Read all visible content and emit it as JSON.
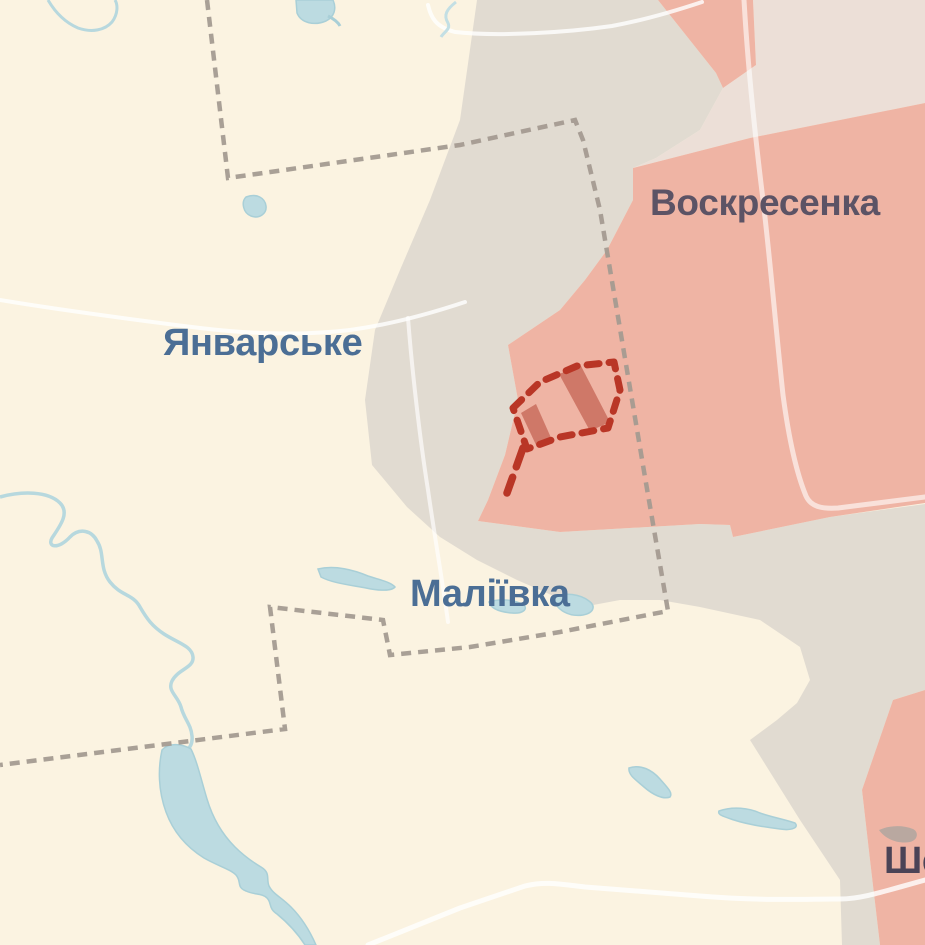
{
  "map": {
    "kind": "frontline-war-map",
    "labels": {
      "voskresenka": "Воскресенка",
      "yanvarske": "Январське",
      "maliivka": "Маліївка",
      "she_partial": "Ше"
    },
    "colors": {
      "background": "#fbf3e1",
      "grey_zone": "#e1dbd1",
      "pale_zone": "#ecdfd7",
      "occupied_pink": "#efb4a4",
      "advance_red": "#b93626",
      "advance_hatch": "rgba(175,60,44,0.5)",
      "admin_boundary": "#a49b91",
      "water_fill": "#bcdbe1",
      "water_stroke": "#a9cfd7",
      "road": "#ffffff",
      "label_blue": "#4b6e95",
      "label_muted_on_pink": "#5c5365",
      "label_dark_on_pink": "#4b4356"
    }
  }
}
